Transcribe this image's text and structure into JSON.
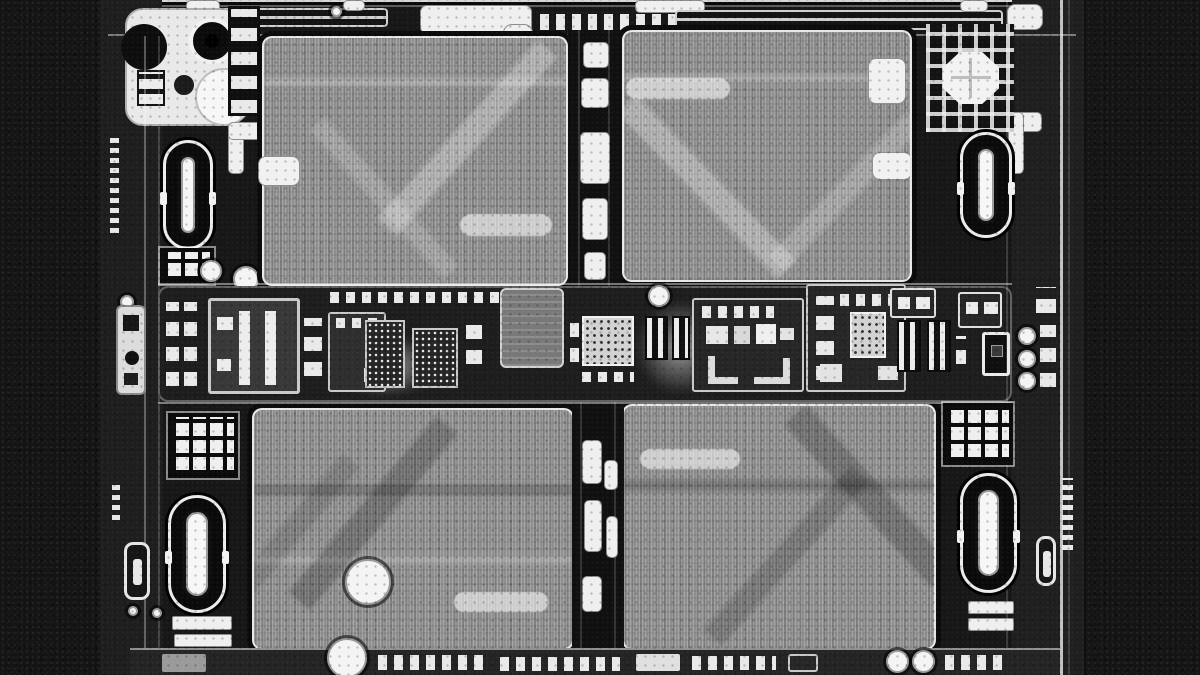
{
  "scene": {
    "description": "Grayscale X-ray photograph of a tablet's internal components viewed from above, framed by black background bands on the left and right",
    "subject": "Tablet internals X-ray",
    "visible_text": "",
    "components": {
      "rear_camera_module": "dual rear camera module with lens, flash ring and sensor grid, top-left corner",
      "battery_cells": "four large rectangular battery cells with fine vertical cell striping, diagonal adhesive bands and bright pull-tab strips",
      "logic_board": "dense horizontal logic board strip across the middle with BGA chips, shielded clusters and board-to-board connectors",
      "speakers": "four racetrack-shaped speaker drivers, one near each corner",
      "antenna_mesh_plates": "white waffle-grid mesh plates beside the speakers",
      "smart_connector": "three round contact pads on the right edge rail",
      "screws": "bright circular fasteners scattered on the chassis",
      "flex_cable_channels": "vertical flex-cable channels between the upper and lower battery pairs",
      "edge_rails": "left and right chassis rails with small connectors, zipper contacts and a capsule connector",
      "top_edge_board": "antenna and component strip along the top edge",
      "bottom_edge_board": "component strip along the bottom edge with round fasteners"
    }
  },
  "palette": {
    "backdrop": "#1a1a1a",
    "device_base": "#171717",
    "battery_gray": "#8f8f8f",
    "board_base": "#1d1d1d",
    "bright_white": "#f2f2f2",
    "dark_part": "#0b0b0b",
    "mid_gray": "#6f6f6f"
  }
}
